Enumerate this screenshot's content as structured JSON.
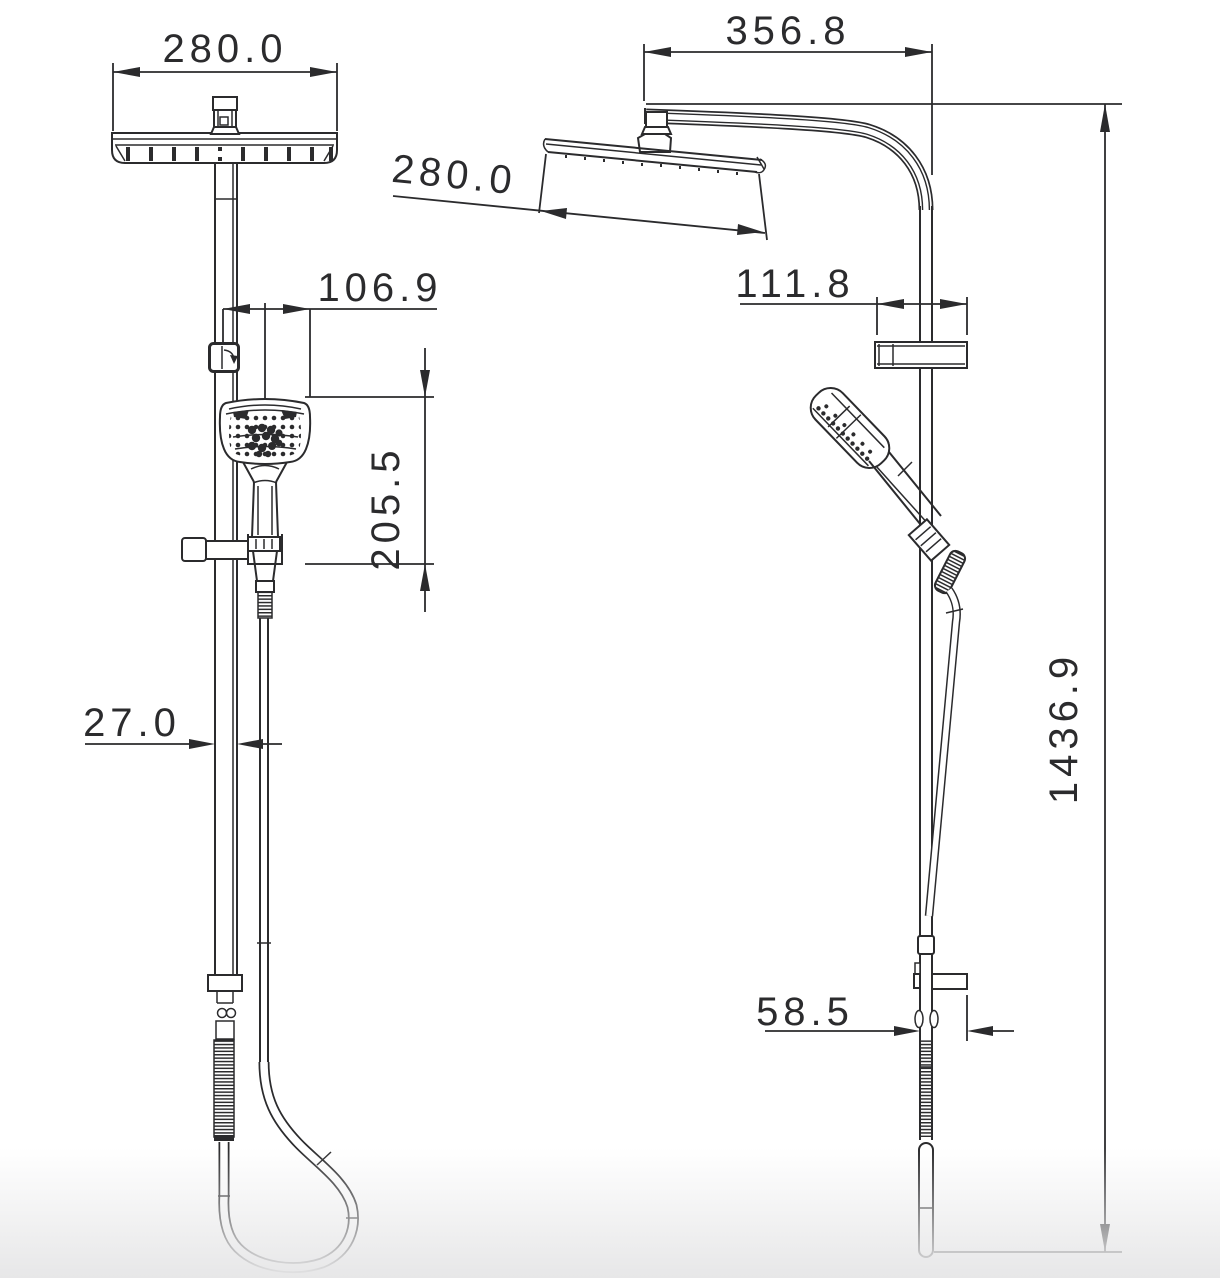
{
  "meta": {
    "drawing_type": "technical dimension drawing",
    "subject": "twin shower column with overhead rain shower head and handheld shower, front and side views",
    "units": "mm"
  },
  "colors": {
    "line": "#2b2b2d",
    "background": "#ffffff",
    "bottom_shade": "#e7e7e8"
  },
  "views": {
    "front": {
      "label": "front-view",
      "dimensions": {
        "head_width": "280.0",
        "handheld_offset": "106.9",
        "handheld_drop": "205.5",
        "rail_width": "27.0"
      }
    },
    "side": {
      "label": "side-view",
      "dimensions": {
        "arm_reach": "356.8",
        "head_depth": "280.0",
        "bracket_width": "111.8",
        "lower_offset": "58.5",
        "total_height": "1436.9"
      }
    }
  }
}
